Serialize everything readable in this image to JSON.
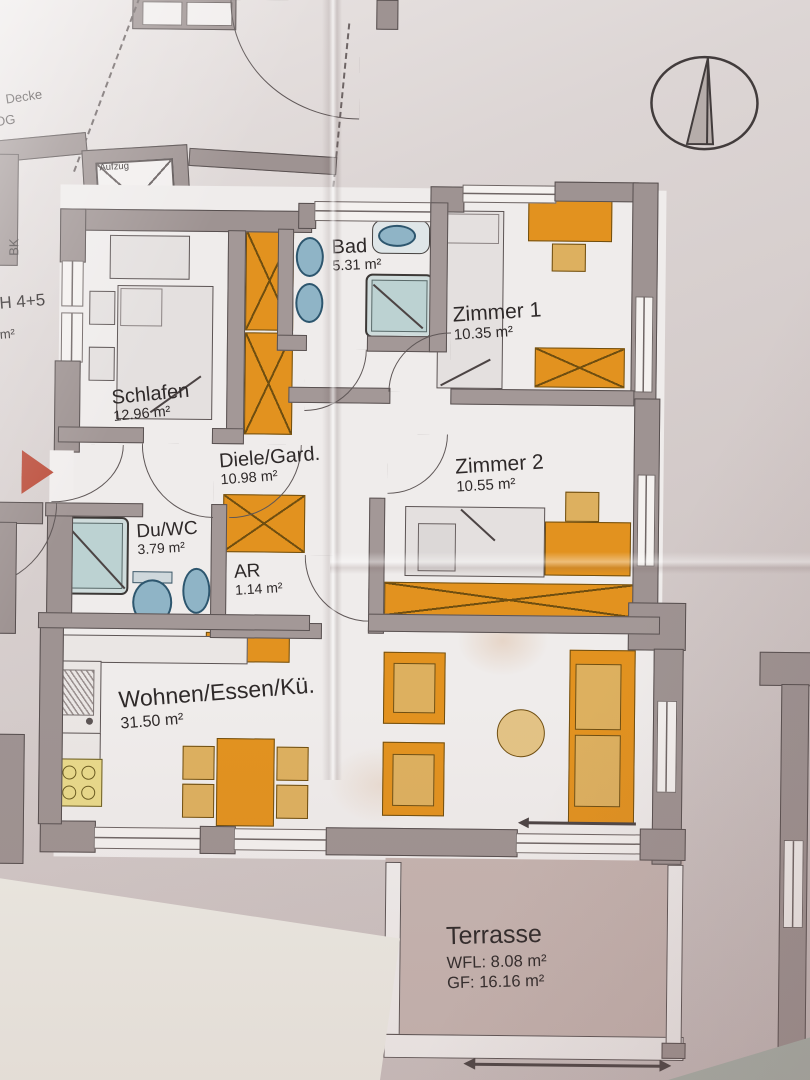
{
  "plan": {
    "rooms": [
      {
        "id": "schlafen",
        "name": "Schlafen",
        "area": "12.96 m²"
      },
      {
        "id": "bad",
        "name": "Bad",
        "area": "5.31 m²"
      },
      {
        "id": "zimmer1",
        "name": "Zimmer 1",
        "area": "10.35 m²"
      },
      {
        "id": "zimmer2",
        "name": "Zimmer 2",
        "area": "10.55 m²"
      },
      {
        "id": "diele",
        "name": "Diele/Gard.",
        "area": "10.98 m²"
      },
      {
        "id": "duwc",
        "name": "Du/WC",
        "area": "3.79 m²"
      },
      {
        "id": "ar",
        "name": "AR",
        "area": "1.14 m²"
      },
      {
        "id": "wohnen",
        "name": "Wohnen/Essen/Kü.",
        "area": "31.50 m²"
      }
    ],
    "terrace": {
      "name": "Terrasse",
      "wfl": "WFL: 8.08 m²",
      "gf": "GF: 16.16 m²"
    },
    "annotations": {
      "elevator": "Aufzug",
      "decke": "Decke",
      "og": "OG",
      "bk": "BK",
      "unit": "H 4+5",
      "unit_area": "2 m²"
    },
    "colors": {
      "wall": "#9e9392",
      "furniture_orange": "#e2921f",
      "upholstery_tan": "#ddb05f",
      "fixture_blue": "#8fb4c6",
      "terrace_floor": "#c5b4b0",
      "paper": "#d8d1d0",
      "entrance_marker_red": "#bd5240"
    }
  }
}
